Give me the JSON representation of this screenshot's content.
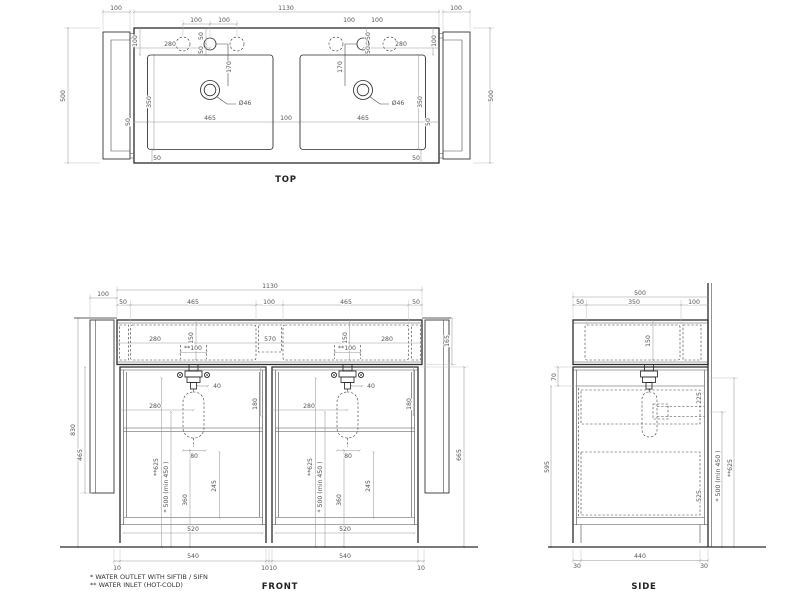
{
  "views": {
    "top": {
      "title": "TOP"
    },
    "front": {
      "title": "FRONT"
    },
    "side": {
      "title": "SIDE"
    }
  },
  "footnotes": [
    "*  WATER OUTLET WITH SIFTIB / SIFN",
    "** WATER INLET (HOT-COLD)"
  ],
  "drain_label": "Ø46",
  "colors": {
    "object_line": "#2b2b2b",
    "dimension_line": "#9a9a9a",
    "dimension_text": "#555555",
    "background": "#ffffff"
  },
  "dims": {
    "top": [
      {
        "t": "100",
        "x": 116,
        "y": 10
      },
      {
        "t": "1130",
        "x": 286,
        "y": 10
      },
      {
        "t": "100",
        "x": 456,
        "y": 10
      },
      {
        "t": "500",
        "x": 65,
        "y": 96,
        "r": 1
      },
      {
        "t": "500",
        "x": 493,
        "y": 96,
        "r": 1
      },
      {
        "t": "100",
        "x": 196,
        "y": 22
      },
      {
        "t": "100",
        "x": 224,
        "y": 22
      },
      {
        "t": "50",
        "x": 203,
        "y": 36,
        "r": 1
      },
      {
        "t": "50",
        "x": 203,
        "y": 50,
        "r": 1
      },
      {
        "t": "100",
        "x": 137,
        "y": 41,
        "r": 1
      },
      {
        "t": "280",
        "x": 170,
        "y": 46
      },
      {
        "t": "170",
        "x": 231,
        "y": 67,
        "r": 1
      },
      {
        "t": "Ø46",
        "x": 245,
        "y": 105
      },
      {
        "t": "350",
        "x": 151,
        "y": 102,
        "r": 1
      },
      {
        "t": "50",
        "x": 130,
        "y": 122,
        "r": 1
      },
      {
        "t": "465",
        "x": 210,
        "y": 120
      },
      {
        "t": "100",
        "x": 286,
        "y": 120
      },
      {
        "t": "465",
        "x": 363,
        "y": 120
      },
      {
        "t": "50",
        "x": 430,
        "y": 122,
        "r": 1
      },
      {
        "t": "50",
        "x": 157,
        "y": 160
      },
      {
        "t": "50",
        "x": 416,
        "y": 160
      },
      {
        "t": "100",
        "x": 349,
        "y": 22
      },
      {
        "t": "100",
        "x": 377,
        "y": 22
      },
      {
        "t": "50",
        "x": 370,
        "y": 36,
        "r": 1
      },
      {
        "t": "50",
        "x": 370,
        "y": 50,
        "r": 1
      },
      {
        "t": "100",
        "x": 436,
        "y": 41,
        "r": 1
      },
      {
        "t": "280",
        "x": 401,
        "y": 46
      },
      {
        "t": "170",
        "x": 342,
        "y": 67,
        "r": 1
      },
      {
        "t": "Ø46",
        "x": 398,
        "y": 105
      },
      {
        "t": "350",
        "x": 422,
        "y": 102,
        "r": 1
      }
    ],
    "front": [
      {
        "t": "100",
        "x": 103,
        "y": 296
      },
      {
        "t": "1130",
        "x": 270,
        "y": 288
      },
      {
        "t": "50",
        "x": 123,
        "y": 304
      },
      {
        "t": "465",
        "x": 193,
        "y": 304
      },
      {
        "t": "100",
        "x": 269,
        "y": 304
      },
      {
        "t": "465",
        "x": 346,
        "y": 304
      },
      {
        "t": "50",
        "x": 416,
        "y": 304
      },
      {
        "t": "150",
        "x": 193,
        "y": 338,
        "r": 1
      },
      {
        "t": "150",
        "x": 347,
        "y": 338,
        "r": 1
      },
      {
        "t": "280",
        "x": 155,
        "y": 341
      },
      {
        "t": "570",
        "x": 270,
        "y": 341
      },
      {
        "t": "280",
        "x": 387,
        "y": 341
      },
      {
        "t": "**100",
        "x": 193,
        "y": 350
      },
      {
        "t": "**100",
        "x": 347,
        "y": 350
      },
      {
        "t": "830",
        "x": 75,
        "y": 430,
        "r": 1
      },
      {
        "t": "465",
        "x": 82,
        "y": 455,
        "r": 1
      },
      {
        "t": "165",
        "x": 449,
        "y": 341,
        "r": 1
      },
      {
        "t": "665",
        "x": 461,
        "y": 455,
        "r": 1
      },
      {
        "t": "40",
        "x": 217,
        "y": 388
      },
      {
        "t": "40",
        "x": 371,
        "y": 388
      },
      {
        "t": "280",
        "x": 155,
        "y": 408
      },
      {
        "t": "280",
        "x": 309,
        "y": 408
      },
      {
        "t": "180",
        "x": 257,
        "y": 404,
        "r": 1
      },
      {
        "t": "180",
        "x": 411,
        "y": 404,
        "r": 1
      },
      {
        "t": "80",
        "x": 194,
        "y": 458
      },
      {
        "t": "80",
        "x": 348,
        "y": 458
      },
      {
        "t": "**625",
        "x": 158,
        "y": 467,
        "r": 1
      },
      {
        "t": "* 500 (min 450 )",
        "x": 168,
        "y": 487,
        "r": 1
      },
      {
        "t": "360",
        "x": 187,
        "y": 500,
        "r": 1
      },
      {
        "t": "245",
        "x": 216,
        "y": 486,
        "r": 1
      },
      {
        "t": "**625",
        "x": 312,
        "y": 467,
        "r": 1
      },
      {
        "t": "* 500 (min 450 )",
        "x": 322,
        "y": 487,
        "r": 1
      },
      {
        "t": "360",
        "x": 341,
        "y": 500,
        "r": 1
      },
      {
        "t": "245",
        "x": 370,
        "y": 486,
        "r": 1
      },
      {
        "t": "520",
        "x": 193,
        "y": 531
      },
      {
        "t": "520",
        "x": 345,
        "y": 531
      },
      {
        "t": "540",
        "x": 193,
        "y": 558
      },
      {
        "t": "540",
        "x": 345,
        "y": 558
      },
      {
        "t": "10",
        "x": 117,
        "y": 570
      },
      {
        "t": "10",
        "x": 265,
        "y": 570
      },
      {
        "t": "10",
        "x": 273,
        "y": 570
      },
      {
        "t": "10",
        "x": 421,
        "y": 570
      }
    ],
    "side": [
      {
        "t": "500",
        "x": 640,
        "y": 295
      },
      {
        "t": "50",
        "x": 580,
        "y": 304
      },
      {
        "t": "350",
        "x": 634,
        "y": 304
      },
      {
        "t": "100",
        "x": 694,
        "y": 304
      },
      {
        "t": "150",
        "x": 650,
        "y": 341,
        "r": 1
      },
      {
        "t": "70",
        "x": 556,
        "y": 377,
        "r": 1
      },
      {
        "t": "595",
        "x": 549,
        "y": 467,
        "r": 1
      },
      {
        "t": "225",
        "x": 701,
        "y": 398,
        "r": 1
      },
      {
        "t": "525",
        "x": 701,
        "y": 496,
        "r": 1
      },
      {
        "t": "* 500 (min 450 )",
        "x": 720,
        "y": 476,
        "r": 1
      },
      {
        "t": "**625",
        "x": 732,
        "y": 468,
        "r": 1
      },
      {
        "t": "30",
        "x": 577,
        "y": 568
      },
      {
        "t": "440",
        "x": 640,
        "y": 558
      },
      {
        "t": "30",
        "x": 704,
        "y": 568
      }
    ]
  }
}
